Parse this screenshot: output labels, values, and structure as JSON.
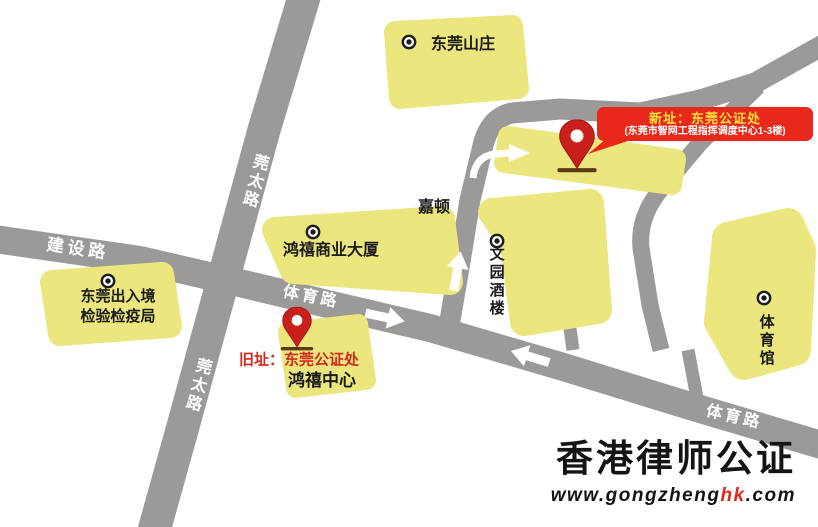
{
  "colors": {
    "road": "#9c9a98",
    "block": "#ebe77e",
    "arrow": "#ffffff",
    "pin": "#c9201b",
    "pin_ground": "#5c3a17",
    "poi_icon": "#1c1c1c",
    "callout_bg": "#e7281b",
    "callout_title": "#ffe13c",
    "callout_subtitle": "#ffffff",
    "old_site_label": "#d3281e",
    "road_label": "#ffffff",
    "logo_highlight": "#e0251c"
  },
  "roads": {
    "jianshe": "建设路",
    "guantai_upper": "莞太路",
    "guantai_lower": "莞太路",
    "tiyu_mid": "体育路",
    "tiyu_lower": "体育路"
  },
  "places": {
    "dongguan_villa": "东莞山庄",
    "jiadun": "嘉顿",
    "hongxi_commercial": "鸿禧商业大厦",
    "bureau_line1": "东莞出入境",
    "bureau_line2": "检验检疫局",
    "hongxi_center": "鸿禧中心",
    "wenyuan_restaurant": "文园酒楼",
    "stadium": "体育馆"
  },
  "callouts": {
    "new_site": {
      "title": "新址：东莞公证处",
      "subtitle": "(东莞市智网工程指挥调度中心1-3楼)"
    },
    "old_site": {
      "label": "旧址：东莞公证处"
    }
  },
  "logo": {
    "title": "香港律师公证",
    "url_prefix": "www.gongzheng",
    "url_highlight": "hk",
    "url_suffix": ".com"
  }
}
